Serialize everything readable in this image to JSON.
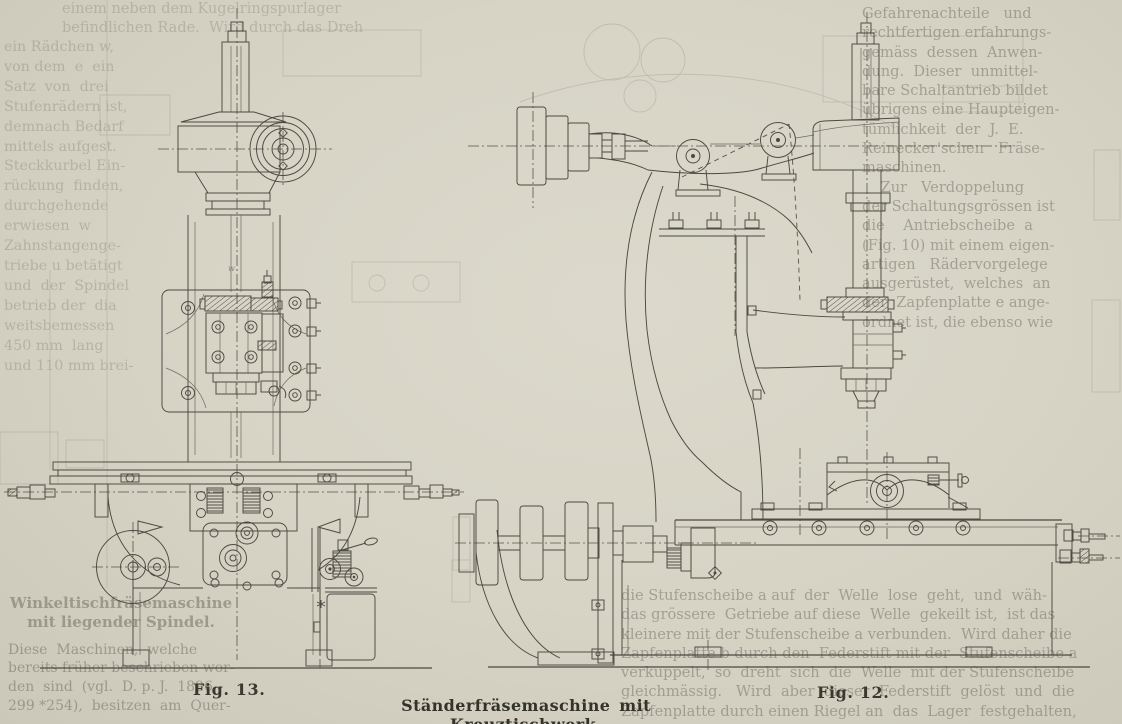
{
  "figure_labels": {
    "fig13": "Fig. 13.",
    "fig12": "Fig. 12."
  },
  "caption": "Ständerfräsemaschine mit Kreuztischwerk.",
  "top_strip": {
    "line1": "einem neben dem Kugelringspurlager",
    "line2": "befindlichen Rade.  Wird durch das Dreh"
  },
  "left_column": {
    "lines": [
      "ein Rädchen w,",
      "von dem  e  ein",
      "Satz  von  drei",
      "Stufenrädern ist,",
      "demnach Bedarf",
      "mittels aufgest.",
      "Steckkurbel Ein-",
      "rückung  finden,",
      "durchgehende",
      "erwiesen  w",
      "Zahnstangenge-",
      "triebe u betätigt",
      "und  der  Spindel",
      "betrieb der  dia",
      "weitsbemessen",
      "450 mm  lang",
      "und 110 mm brei-"
    ]
  },
  "right_column": {
    "lines": [
      "Gefahrenachteile   und",
      "rechtfertigen erfahrungs-",
      "gemäss  dessen  Anwen-",
      "dung.  Dieser  unmittel-",
      "bare Schaltantrieb bildet",
      "übrigens eine Haupteigen-",
      "tümlichkeit  der  J.  E.",
      "Reinecker'schen   Fräse-",
      "maschinen.",
      "    Zur   Verdoppelung",
      "der Schaltungsgrössen ist",
      "die    Antriebscheibe  a",
      "(Fig. 10) mit einem eigen-",
      "artigen   Rädervorgelege",
      "ausgerüstet,  welches  an",
      "der  Zapfenplatte e ange-",
      "ordnet ist, die ebenso wie"
    ]
  },
  "bottom_left": {
    "heading1": "Winkeltischfräsemaschine",
    "heading2": "mit liegender Spindel.",
    "lines": [
      "Diese  Maschinen,  welche",
      "bereits früher beschrieben wor-",
      "den  sind  (vgl.  D. p. J.  1896",
      "299 *254),  besitzen  am  Quer-"
    ]
  },
  "bottom_right": {
    "lines": [
      "die Stufenscheibe a auf  der  Welle  lose  geht,  und  wäh-",
      "das grössere  Getriebe auf diese  Welle  gekeilt ist,  ist das",
      "kleinere mit der Stufenscheibe a verbunden.  Wird daher die",
      "Zapfenplatte b durch den  Federstift mit der  Stufenscheibe a",
      "verkuppelt,  so  dreht  sich  die  Welle  mit der Stufenscheibe",
      "gleichmässig.   Wird  aber  dieser  Federstift  gelöst  und  die",
      "Zapfenplatte durch einen Riegel an  das  Lager  festgehalten,"
    ]
  }
}
